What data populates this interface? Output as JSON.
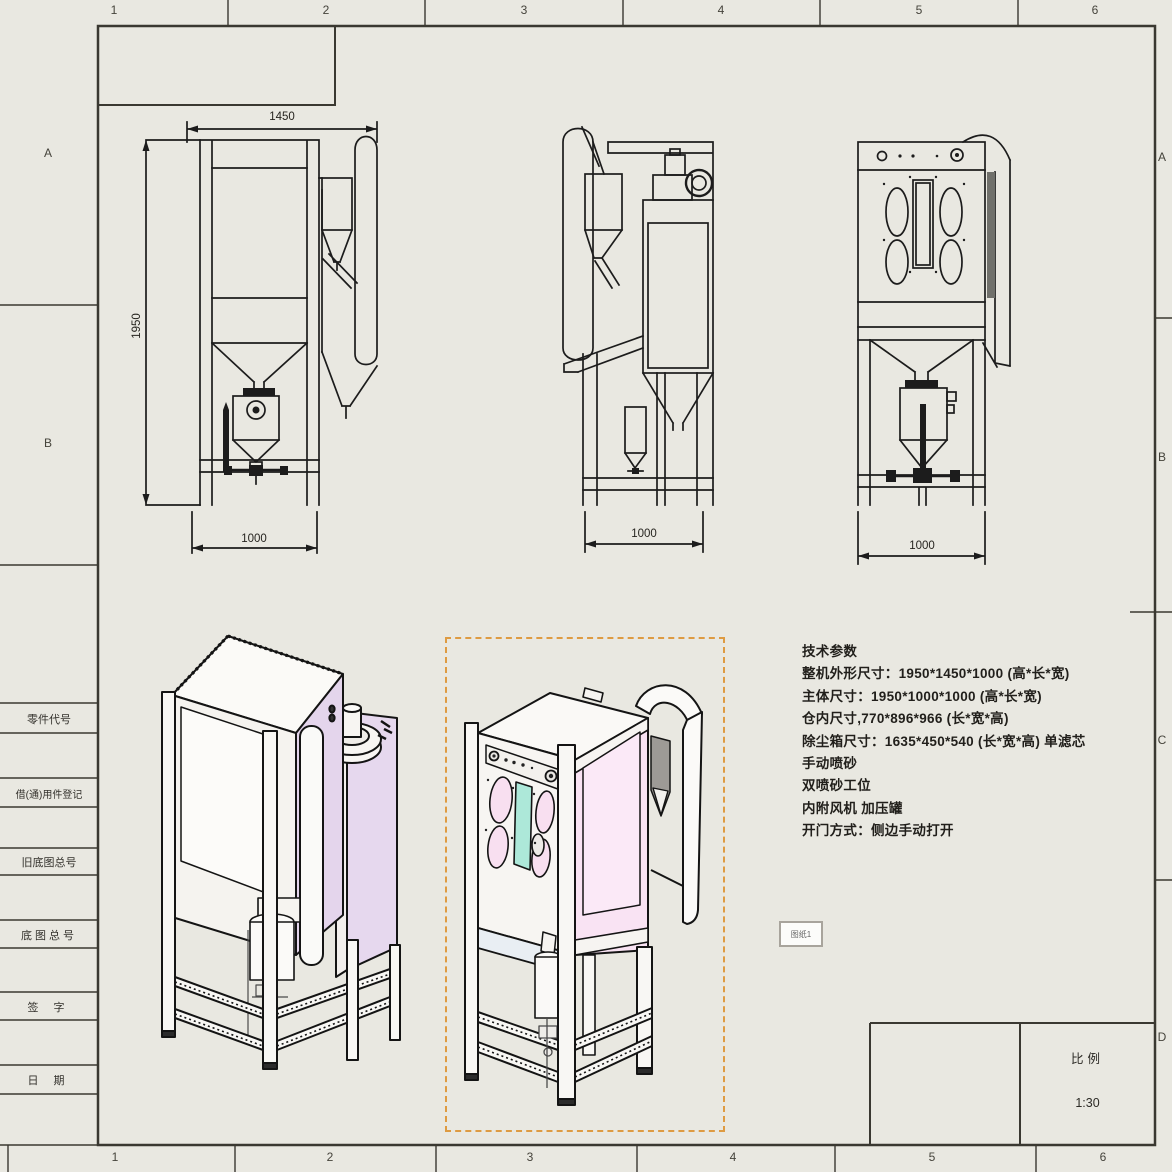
{
  "sheet": {
    "background": "#e9e8e1",
    "border_color": "#3a3831",
    "grid": {
      "top": [
        "1",
        "2",
        "3",
        "4",
        "5",
        "6"
      ],
      "bottom": [
        "1",
        "2",
        "3",
        "4",
        "5",
        "6"
      ],
      "left": [
        "A",
        "B"
      ],
      "right": [
        "A",
        "B",
        "C",
        "D"
      ]
    },
    "title_strip": {
      "rows": [
        "零件代号",
        "借(通)用件登记",
        "旧底图总号",
        "底图总号",
        "签 字",
        "日 期"
      ]
    },
    "scale_block": {
      "label": "比例",
      "value": "1:30"
    }
  },
  "views": {
    "side": {
      "top_dim": "1450",
      "left_dim": "1950",
      "bottom_dim": "1000"
    },
    "rear": {
      "bottom_dim": "1000"
    },
    "front": {
      "bottom_dim": "1000"
    }
  },
  "tech_params": {
    "lines": [
      "技术参数",
      "整机外形尺寸：1950*1450*1000 (高*长*宽)",
      "主体尺寸：1950*1000*1000 (高*长*宽)",
      "仓内尺寸,770*896*966 (长*宽*高)",
      "除尘箱尺寸：1635*450*540 (长*宽*高) 单滤芯",
      "手动喷砂",
      "双喷砂工位",
      "内附风机 加压罐",
      "开门方式：侧边手动打开"
    ]
  },
  "annotation": {
    "tag": "图纸1"
  },
  "selection": {
    "color": "#de9b42"
  },
  "colors": {
    "lavender": "#e4d5ec",
    "pink": "#f9e2f2",
    "pink_oval": "#f8dff0",
    "cyan_window": "#ade8d9",
    "line": "#1c1c1c"
  }
}
